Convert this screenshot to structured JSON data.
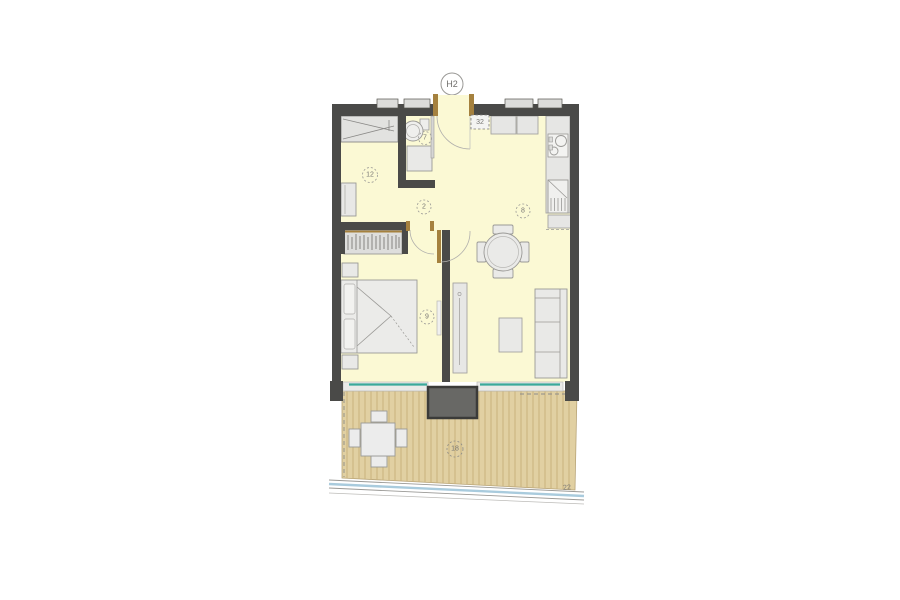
{
  "plan": {
    "unit_label": "H2",
    "labels": {
      "entry": "12",
      "bathroom": "7",
      "shaft": "32",
      "hall": "2",
      "living": "8",
      "bedroom": "9",
      "terrace": "18",
      "boundary": "22"
    },
    "colors": {
      "wall": "#4a4a48",
      "room_fill": "#fbf9d4",
      "furniture_fill": "#e8e8e8",
      "furniture_stroke": "#999999",
      "wood_frame": "#a5813e",
      "window_glass": "#3aa99a",
      "terrace_fill": "#e1d0a2",
      "terrace_plank": "#c9b27c",
      "column": "#686865",
      "boundary_line": "#a9cbdd",
      "label": "#777673"
    }
  }
}
